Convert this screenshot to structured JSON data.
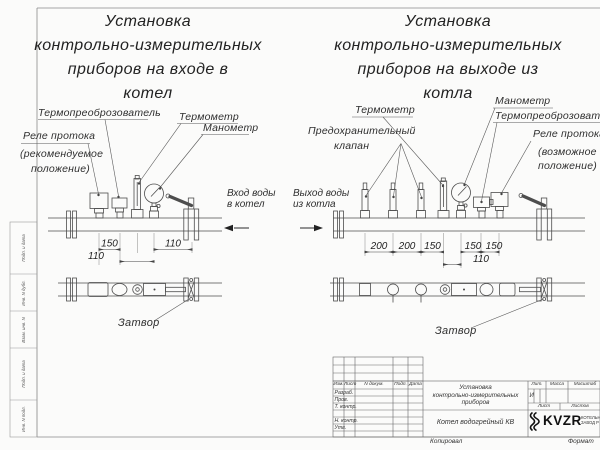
{
  "sheet": {
    "copied_label": "Копировал",
    "format_label": "Формат"
  },
  "left_diagram": {
    "title": [
      "Установка",
      "контрольно-измерительных",
      "приборов на входе в",
      "котел"
    ],
    "labels": {
      "thermotransducer": "Термопреоброзователь",
      "thermometer": "Термометр",
      "manometer": "Манометр",
      "flow_relay": [
        "Реле протока",
        "(рекомендуемое",
        "положение)"
      ],
      "inlet": [
        "Вход воды",
        "в котел"
      ],
      "valve": "Затвор"
    },
    "dims": {
      "a": "150",
      "b": "110",
      "c": "110"
    }
  },
  "right_diagram": {
    "title": [
      "Установка",
      "контрольно-измерительных",
      "приборов на выходе из",
      "котла"
    ],
    "labels": {
      "thermometer": "Термометр",
      "manometer": "Манометр",
      "thermotransducer": "Термопреоброзователь",
      "safety_valve": [
        "Предохранительный",
        "клапан"
      ],
      "flow_relay": [
        "Реле протока",
        "(возможное",
        "положение)"
      ],
      "outlet": [
        "Выход воды",
        "из котла"
      ],
      "valve": "Затвор"
    },
    "dims": {
      "a": "200",
      "b": "200",
      "c": "150",
      "d": "150",
      "e": "150",
      "f": "110"
    }
  },
  "title_block": {
    "header_cols": [
      "Изм.",
      "Лист",
      "N докум.",
      "Подп.",
      "Дата"
    ],
    "rows": [
      "Разраб.",
      "Пров.",
      "Т. контр.",
      "Н. контр.",
      "Утв."
    ],
    "doc_title": [
      "Установка",
      "контрольно-измерительных",
      "приборов"
    ],
    "product": "Котел водогрейный КВ",
    "lit_label": "Лит.",
    "mass_label": "Масса",
    "scale_label": "Масштаб",
    "lit_value": "И",
    "sheet_label": "Лист",
    "sheets_label": "Листов",
    "logo_text": "KVZR",
    "logo_sub": [
      "КОТЕЛЬНЫЙ",
      "ЗАВОД Р"
    ]
  },
  "margin_labels": [
    "Подп. и дата",
    "Инв. N дубл.",
    "Взам. инв. N",
    "Подп. и дата",
    "Инв. N подл."
  ]
}
